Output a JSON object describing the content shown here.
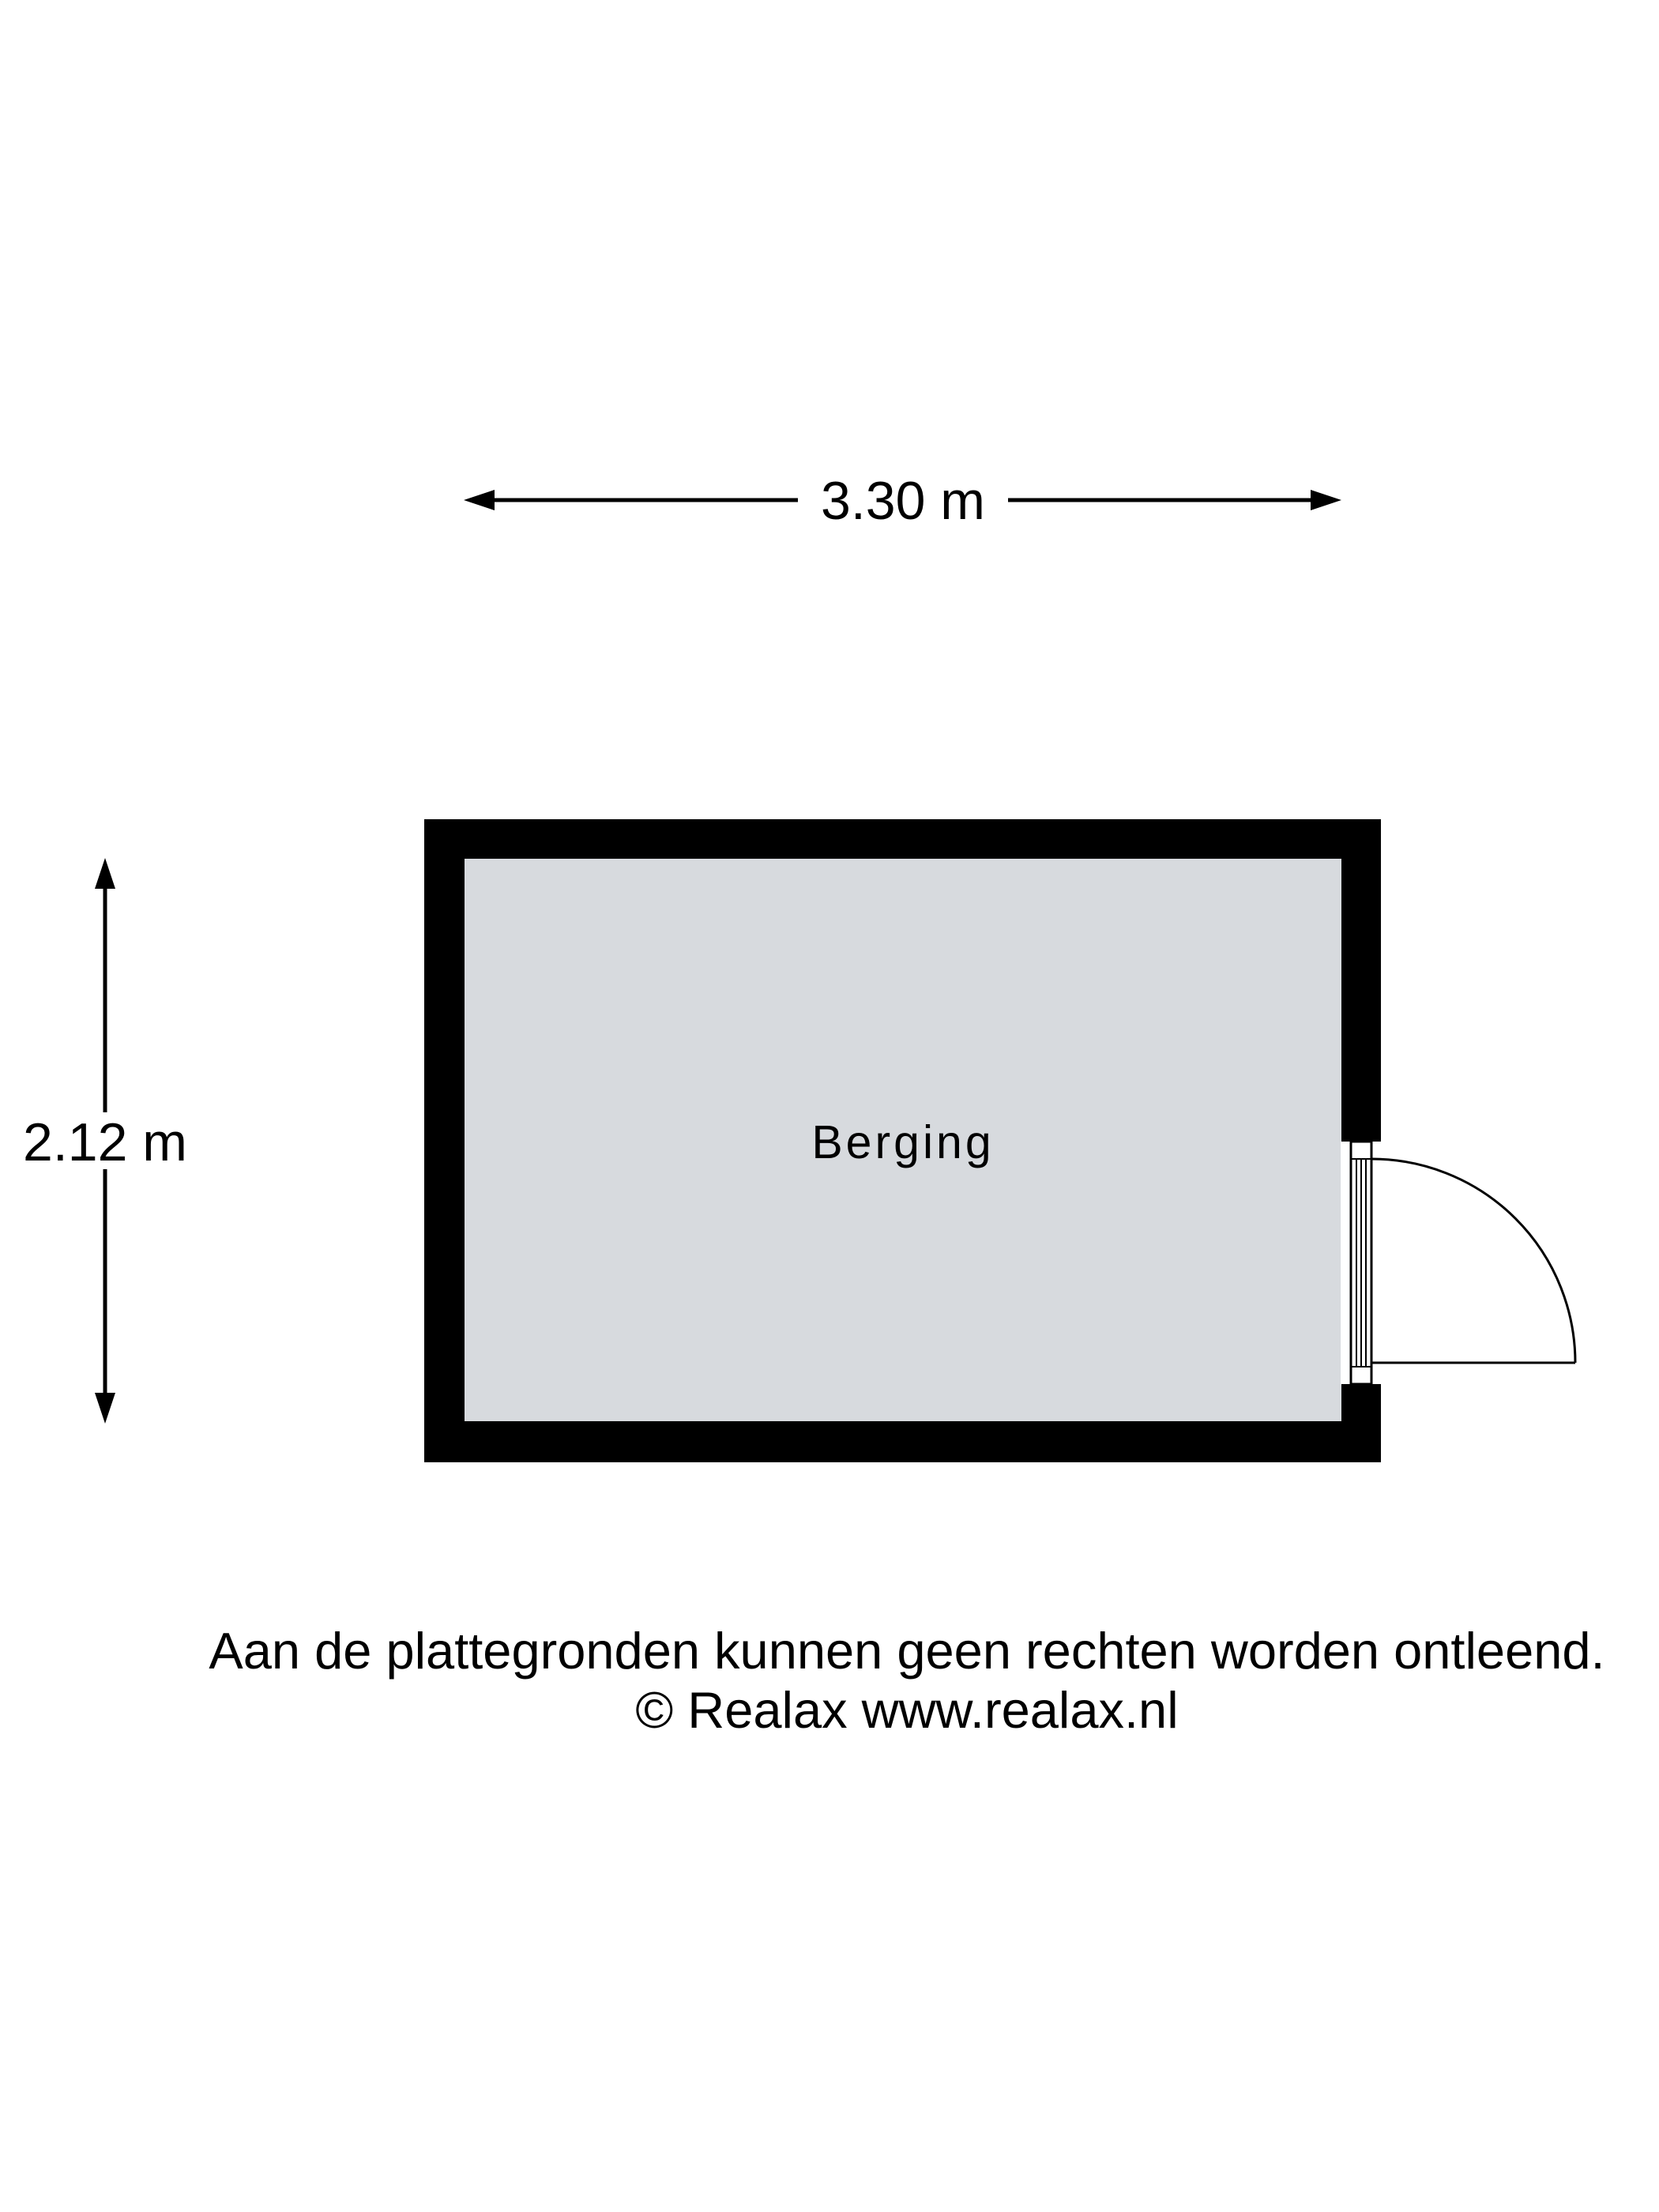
{
  "dimensions": {
    "width_label": "3.30 m",
    "height_label": "2.12 m"
  },
  "room": {
    "name": "Berging"
  },
  "footer": {
    "disclaimer": "Aan de plattegronden kunnen geen rechten worden ontleend.",
    "copyright": "© Realax www.realax.nl"
  },
  "colors": {
    "wall": "#000000",
    "floor": "#d7dade",
    "background": "#ffffff",
    "line": "#000000"
  }
}
